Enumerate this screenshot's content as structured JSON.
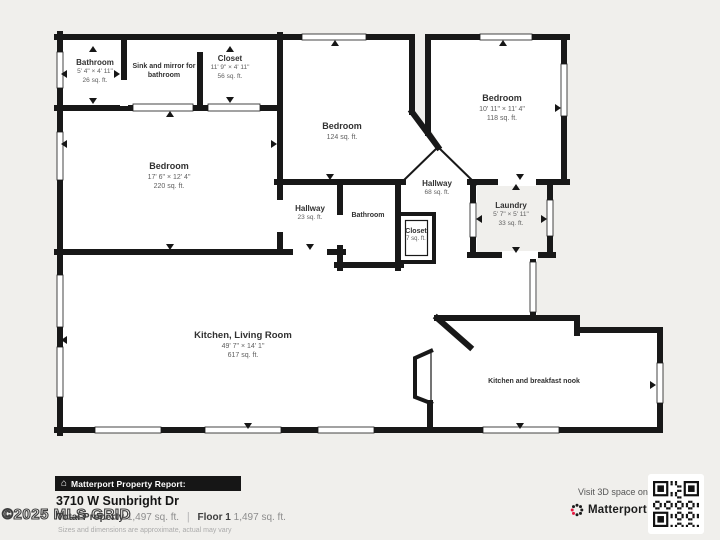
{
  "colors": {
    "background": "#f0efec",
    "wall": "#181818",
    "accent_red": "#e5173f"
  },
  "rooms": [
    {
      "name": "Bathroom",
      "dims": "5' 4\" × 4' 11\"",
      "area": "26 sq. ft."
    },
    {
      "name": "Sink and mirror for bathroom"
    },
    {
      "name": "Closet",
      "dims": "11' 9\" × 4' 11\"",
      "area": "56 sq. ft."
    },
    {
      "name": "Bedroom",
      "dims": "17' 6\" × 12' 4\"",
      "area": "220 sq. ft."
    },
    {
      "name": "Bedroom",
      "area": "124 sq. ft."
    },
    {
      "name": "Bedroom",
      "dims": "10' 11\" × 11' 4\"",
      "area": "118 sq. ft."
    },
    {
      "name": "Hallway",
      "area": "23 sq. ft."
    },
    {
      "name": "Bathroom"
    },
    {
      "name": "Hallway",
      "area": "68 sq. ft."
    },
    {
      "name": "Closet",
      "area": "7 sq. ft."
    },
    {
      "name": "Laundry",
      "dims": "5' 7\" × 5' 11\"",
      "area": "33 sq. ft."
    },
    {
      "name": "Kitchen, Living Room",
      "dims": "49' 7\" × 14' 1\"",
      "area": "617 sq. ft."
    },
    {
      "name": "Kitchen and breakfast nook"
    }
  ],
  "footer": {
    "report_bar": "Matterport Property Report:",
    "house_icon": "⌂",
    "address": "3710 W Sunbright Dr",
    "watermark": "©2025 MLS GRID",
    "total_label": "Total Property",
    "total_value": "1,497 sq. ft.",
    "separator": "|",
    "floor_label": "Floor 1",
    "floor_value": "1,497 sq. ft.",
    "disclaimer": "Sizes and dimensions are approximate, actual may vary",
    "visit_text": "Visit 3D space on",
    "brand": "Matterport",
    "brand_tm": "™"
  }
}
